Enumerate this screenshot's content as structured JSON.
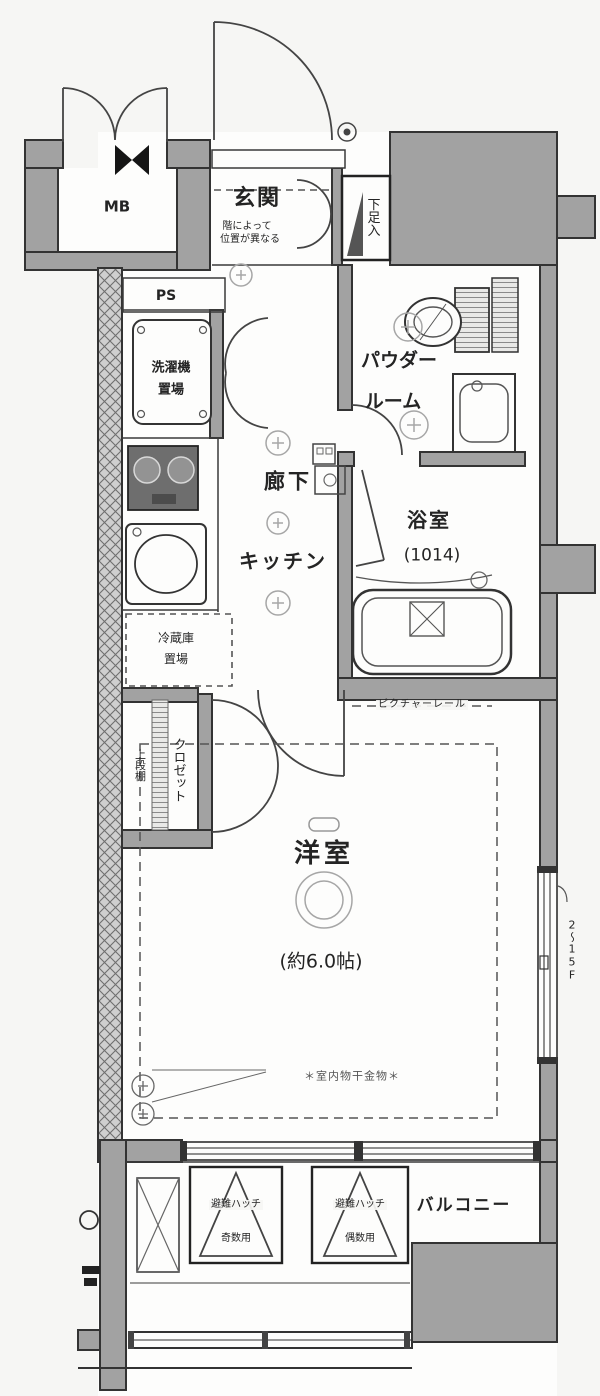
{
  "labels": {
    "mb": "MB",
    "entrance": "玄関",
    "entrance_note_line1": "階によって",
    "entrance_note_line2": "位置が異なる",
    "shoe_cabinet": "下足入",
    "ps": "PS",
    "washer_line1": "洗濯機",
    "washer_line2": "置場",
    "powder_line1": "パウダー",
    "powder_line2": "ルーム",
    "hallway": "廊下",
    "kitchen": "キッチン",
    "bathroom": "浴室",
    "bathroom_size": "(1014)",
    "fridge_line1": "冷蔵庫",
    "fridge_line2": "置場",
    "closet": "クロゼット",
    "upper_shelf": "上段棚",
    "picture_rail": "ピクチャーレール",
    "western_room": "洋室",
    "western_room_size": "(約6.0帖)",
    "laundry_hardware": "＊室内物干金物＊",
    "balcony": "バルコニー",
    "hatch1_line1": "避難ハッチ",
    "hatch1_line2": "奇数用",
    "hatch2_line1": "避難ハッチ",
    "hatch2_line2": "偶数用",
    "window_floor_note": "2〜15F"
  },
  "colors": {
    "wall_fill": "#a2a2a2",
    "hatched_wall_fill": "#cfcfcf",
    "line": "#333333",
    "floor": "#fdfdfc",
    "background": "#f6f6f4",
    "text": "#242424"
  }
}
